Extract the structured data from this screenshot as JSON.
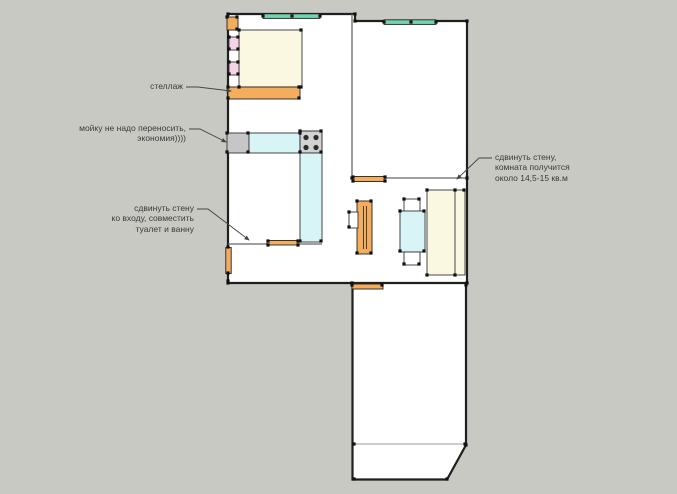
{
  "scene": {
    "type": "apartment-floor-plan-sketch",
    "units_note": "кв.м"
  },
  "palette": {
    "background": "#c9c9c4",
    "floor": "#ffffff",
    "wall": "#1f1f1f",
    "interior_wall": "#666666",
    "furniture_orange": "#f4ad5d",
    "furniture_cream": "#fbf8e1",
    "furniture_pink": "#f6d3e6",
    "furniture_cyan": "#d8f4f6",
    "window_teal": "#72d3ae",
    "sink_gray": "#c6c6c6",
    "stove_gray": "#d2d2d2",
    "burner_dark": "#2b2b2b",
    "annotation_text": "#3a3a3a",
    "leader_line": "#444444"
  },
  "annotations": [
    {
      "id": "shelf",
      "text": "стеллаж",
      "align": "right"
    },
    {
      "id": "sink",
      "text": "мойку не надо переносить,\nэкономия))))",
      "align": "right"
    },
    {
      "id": "entry-wall",
      "text": "сдвинуть стену\nко входу, совместить\nтуалет и ванну",
      "align": "right"
    },
    {
      "id": "room-wall",
      "text": "сдвинуть стену,\nкомната получится\nоколо 14,5-15 кв.м",
      "align": "left"
    }
  ],
  "elements": [
    {
      "name": "bed",
      "color_key": "furniture_cream"
    },
    {
      "name": "nightstand",
      "count": 2,
      "color_key": "furniture_pink"
    },
    {
      "name": "shelving-unit",
      "color_key": "furniture_orange"
    },
    {
      "name": "corner-cabinet",
      "color_key": "furniture_orange"
    },
    {
      "name": "sink",
      "color_key": "sink_gray"
    },
    {
      "name": "kitchen-counter",
      "color_key": "furniture_cyan"
    },
    {
      "name": "stove",
      "burners": 4,
      "color_key": "stove_gray"
    },
    {
      "name": "wardrobe",
      "color_key": "furniture_orange"
    },
    {
      "name": "dining-table",
      "color_key": "furniture_cyan"
    },
    {
      "name": "chair",
      "count": 2,
      "color_key": "floor"
    },
    {
      "name": "sofa",
      "color_key": "furniture_cream"
    },
    {
      "name": "window",
      "count": 2,
      "color_key": "window_teal"
    },
    {
      "name": "door",
      "count": 4,
      "color_key": "furniture_orange"
    },
    {
      "name": "balcony",
      "color_key": "floor"
    }
  ]
}
